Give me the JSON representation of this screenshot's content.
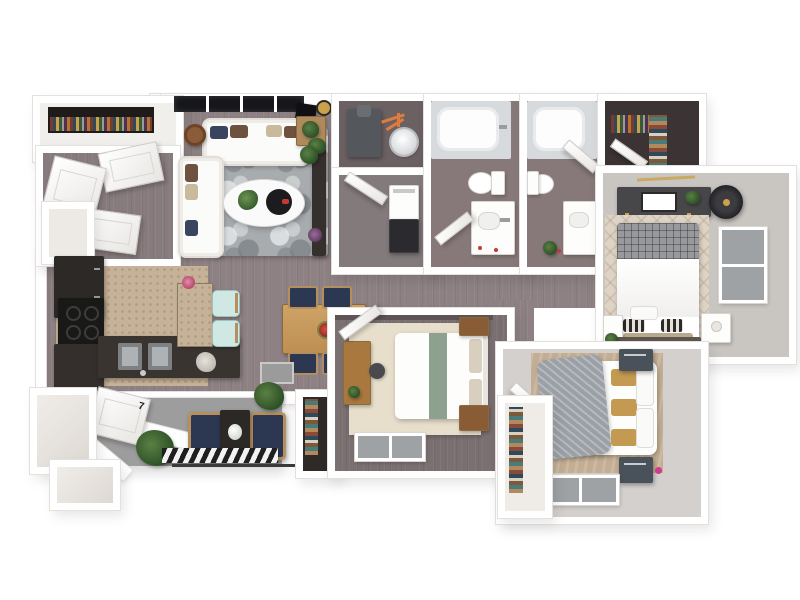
{
  "meta": {
    "type": "3d-floor-plan-render",
    "view": "top-down isometric",
    "background": "#ffffff"
  },
  "door_number": "7",
  "colors": {
    "wall": "#ffffff",
    "wall_edge": "#e3e0dd",
    "floor_main": "#8d8183",
    "floor_foyer": "#877b7d",
    "floor_utility": "#6b6062",
    "floor_laundry": "#837a7b",
    "floor_bath": "#87797a",
    "floor_closet": "#3b3334",
    "floor_master": "#c9c6c2",
    "floor_bed2": "#7a6f71",
    "floor_bed3": "#d3d0cd",
    "floor_balcony": "#9d9d9d",
    "kitchen_floor": "#c6b298",
    "cabinet_dark": "#2c2927",
    "wood": "#c79a5e",
    "navy": "#2c3752",
    "seafoam": "#cfe8e4",
    "sage": "#8ea18e",
    "mustard": "#c49a52",
    "orange_pipe": "#e07b3f",
    "gray_throw": "#9aa0a5",
    "slate": "#49525a",
    "glass": "#9ea2a5",
    "rug_master": "#ded4c5",
    "rug_cream": "#e7decb",
    "rug_tan": "#c3ae93",
    "black_window": "#17171a",
    "gold": "#c9a24a",
    "pink_accent": "#d23a8c",
    "red_accent": "#c43a32"
  },
  "rooms": [
    {
      "id": "entry-closet",
      "label": "entry bookshelf closet"
    },
    {
      "id": "foyer",
      "label": "entry foyer with open doors"
    },
    {
      "id": "living-room",
      "label": "living room"
    },
    {
      "id": "kitchen",
      "label": "kitchen"
    },
    {
      "id": "dining",
      "label": "dining area"
    },
    {
      "id": "utility",
      "label": "utility room with furnace and water heater"
    },
    {
      "id": "laundry",
      "label": "laundry closet with stacked washer dryer"
    },
    {
      "id": "bathroom-1",
      "label": "bathroom with tub, toilet, vanity"
    },
    {
      "id": "bathroom-2",
      "label": "bathroom with tub, toilet, vanity"
    },
    {
      "id": "walk-in-closet",
      "label": "walk-in closet"
    },
    {
      "id": "master-bedroom",
      "label": "master bedroom"
    },
    {
      "id": "bedroom-2",
      "label": "bedroom with desk"
    },
    {
      "id": "bedroom-3",
      "label": "bedroom with knit throw"
    },
    {
      "id": "hallway",
      "label": "hallway"
    },
    {
      "id": "balcony",
      "label": "entry patio / balcony"
    }
  ],
  "furniture": {
    "living_room": [
      "two white sofas",
      "marbled gray rug",
      "oval coffee table with plant and tray",
      "round side table",
      "square side table",
      "floor lamp",
      "dark plant console",
      "black framed windows"
    ],
    "kitchen": [
      "dark cabinets",
      "cooktop",
      "island with double sink",
      "bar counter",
      "two seafoam stools"
    ],
    "dining": [
      "wood dining table",
      "four navy chairs",
      "red centerpiece",
      "gray mat"
    ],
    "utility": [
      "furnace",
      "water heater",
      "orange piping"
    ],
    "laundry": [
      "stacked washer and dryer"
    ],
    "bathrooms": [
      "bathtub",
      "toilet",
      "vanity sink"
    ],
    "master_bedroom": [
      "dark dresser with art",
      "round ceiling light",
      "diamond patterned rug",
      "bed with plaid blanket",
      "two white nightstands",
      "window",
      "bench"
    ],
    "bedroom_2": [
      "bed with sage runner",
      "wood desk and chair",
      "two wood nightstands",
      "window"
    ],
    "bedroom_3": [
      "bed with gray knit throw and mustard pillows",
      "two slate nightstands",
      "tan rug",
      "window",
      "shelf closet"
    ],
    "balcony": [
      "two navy patio chairs",
      "dark side table with white flowers",
      "plants",
      "striped door mat",
      "front door numbered 7"
    ],
    "closets": [
      "book shelf",
      "hanging clothes",
      "folded clothes stacks"
    ]
  }
}
